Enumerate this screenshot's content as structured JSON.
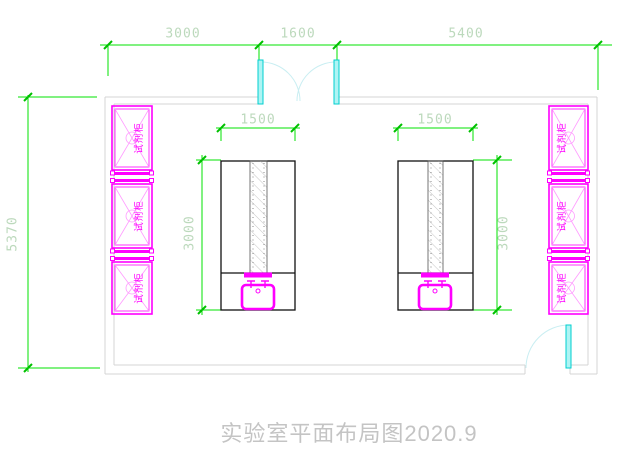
{
  "title": {
    "text": "实验室平面布局图2020.9"
  },
  "dimensions": {
    "top": [
      "3000",
      "1600",
      "5400"
    ],
    "left_overall": "5370",
    "left_table": {
      "width": "1500",
      "depth": "3000"
    },
    "right_table": {
      "width": "1500",
      "depth": "3000"
    }
  },
  "cabinets": {
    "label": "试剂柜",
    "left_count": 3,
    "right_count": 3
  },
  "colors": {
    "dimension_line": "#00e300",
    "dimension_text": "#bcd9bc",
    "furniture": "#ff00ff",
    "door_leaf": "#00cfcf",
    "door_arc": "#c9eef2",
    "wall": "#d4d4d4",
    "table_outline": "#111111",
    "title_text": "#c4c4c4"
  }
}
